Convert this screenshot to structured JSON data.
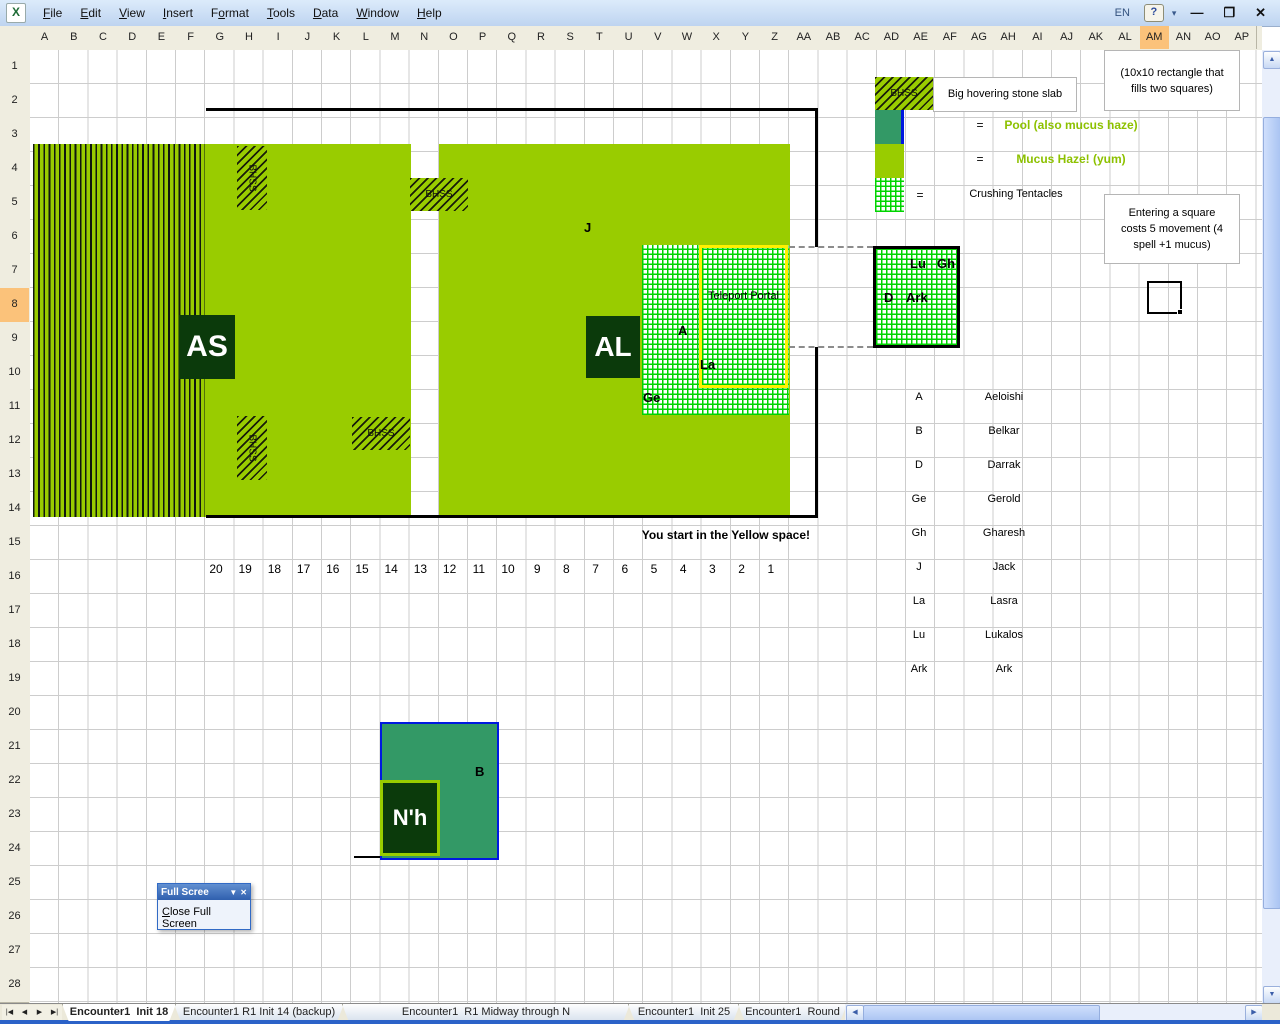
{
  "colors": {
    "mucus": "#99CC00",
    "pool": "#339966",
    "dark": "#0b3a0b",
    "tentacle": "#00d400",
    "portal": "#fff000",
    "poolborder": "#0018e0",
    "legendtext": "#8dc100"
  },
  "menu": {
    "items": [
      {
        "label": "File",
        "accel": 0
      },
      {
        "label": "Edit",
        "accel": 0
      },
      {
        "label": "View",
        "accel": 0
      },
      {
        "label": "Insert",
        "accel": 0
      },
      {
        "label": "Format",
        "accel": 1
      },
      {
        "label": "Tools",
        "accel": 0
      },
      {
        "label": "Data",
        "accel": 0
      },
      {
        "label": "Window",
        "accel": 0
      },
      {
        "label": "Help",
        "accel": 0
      }
    ],
    "language_indicator": "EN",
    "help_icon": "?",
    "toolbar_options_icon": "▾"
  },
  "window_controls": {
    "minimize": "—",
    "restore": "❐",
    "close": "✕"
  },
  "grid": {
    "columns": [
      "A",
      "B",
      "C",
      "D",
      "E",
      "F",
      "G",
      "H",
      "I",
      "J",
      "K",
      "L",
      "M",
      "N",
      "O",
      "P",
      "Q",
      "R",
      "S",
      "T",
      "U",
      "V",
      "W",
      "X",
      "Y",
      "Z",
      "AA",
      "AB",
      "AC",
      "AD",
      "AE",
      "AF",
      "AG",
      "AH",
      "AI",
      "AJ",
      "AK",
      "AL",
      "AM",
      "AN",
      "AO",
      "AP"
    ],
    "rows": [
      "1",
      "2",
      "3",
      "4",
      "5",
      "6",
      "7",
      "8",
      "9",
      "10",
      "11",
      "12",
      "13",
      "14",
      "15",
      "16",
      "17",
      "18",
      "19",
      "20",
      "21",
      "22",
      "23",
      "24",
      "25",
      "26",
      "27",
      "28"
    ],
    "selected_column": "AM",
    "selected_row": "8"
  },
  "map": {
    "bhss_label": "BHSS",
    "as_label": "AS",
    "al_label": "AL",
    "j_label": "J",
    "a_label": "A",
    "la_label": "La",
    "ge_label": "Ge",
    "teleport_label": "Teleport Portal",
    "lu_label": "Lu",
    "gh_label": "Gh",
    "d_label": "D",
    "ark_label": "Ark",
    "start_text": "You start in the Yellow space!",
    "pool_b_label": "B",
    "nh_label": "N'h"
  },
  "legend": {
    "slab_text": "Big hovering stone slab",
    "eq": "=",
    "pool_text": "Pool (also mucus haze)",
    "mucus_text": "Mucus Haze! (yum)",
    "tentacles_text": "Crushing Tentacles",
    "note_10x10_line1": "(10x10 rectangle that",
    "note_10x10_line2": "fills two squares)",
    "note_enter_line1": "Entering a square",
    "note_enter_line2": "costs 5 movement (4",
    "note_enter_line3": "spell +1 mucus)"
  },
  "names": {
    "rows": [
      {
        "abbr": "A",
        "name": "Aeloishi"
      },
      {
        "abbr": "B",
        "name": "Belkar"
      },
      {
        "abbr": "D",
        "name": "Darrak"
      },
      {
        "abbr": "Ge",
        "name": "Gerold"
      },
      {
        "abbr": "Gh",
        "name": "Gharesh"
      },
      {
        "abbr": "J",
        "name": "Jack"
      },
      {
        "abbr": "La",
        "name": "Lasra"
      },
      {
        "abbr": "Lu",
        "name": "Lukalos"
      },
      {
        "abbr": "Ark",
        "name": "Ark"
      }
    ]
  },
  "numbers_row": {
    "values": [
      "20",
      "19",
      "18",
      "17",
      "16",
      "15",
      "14",
      "13",
      "12",
      "11",
      "10",
      "9",
      "8",
      "7",
      "6",
      "5",
      "4",
      "3",
      "2",
      "1"
    ]
  },
  "fullscreen_toolbar": {
    "title": "Full Scree",
    "dropdown_icon": "▼",
    "close_icon": "✕",
    "close_label": "Close Full Screen",
    "close_accel": 0
  },
  "tabs": {
    "nav": [
      "|◀",
      "◀",
      "▶",
      "▶|"
    ],
    "items": [
      "Encounter1  Init 18",
      "Encounter1 R1 Init 14 (backup)",
      "Encounter1  R1 Midway through N",
      "Encounter1  Init 25",
      "Encounter1  Round"
    ],
    "active_index": 0
  },
  "scrollbars": {
    "up": "▲",
    "down": "▼",
    "left": "◀",
    "right": "▶"
  }
}
